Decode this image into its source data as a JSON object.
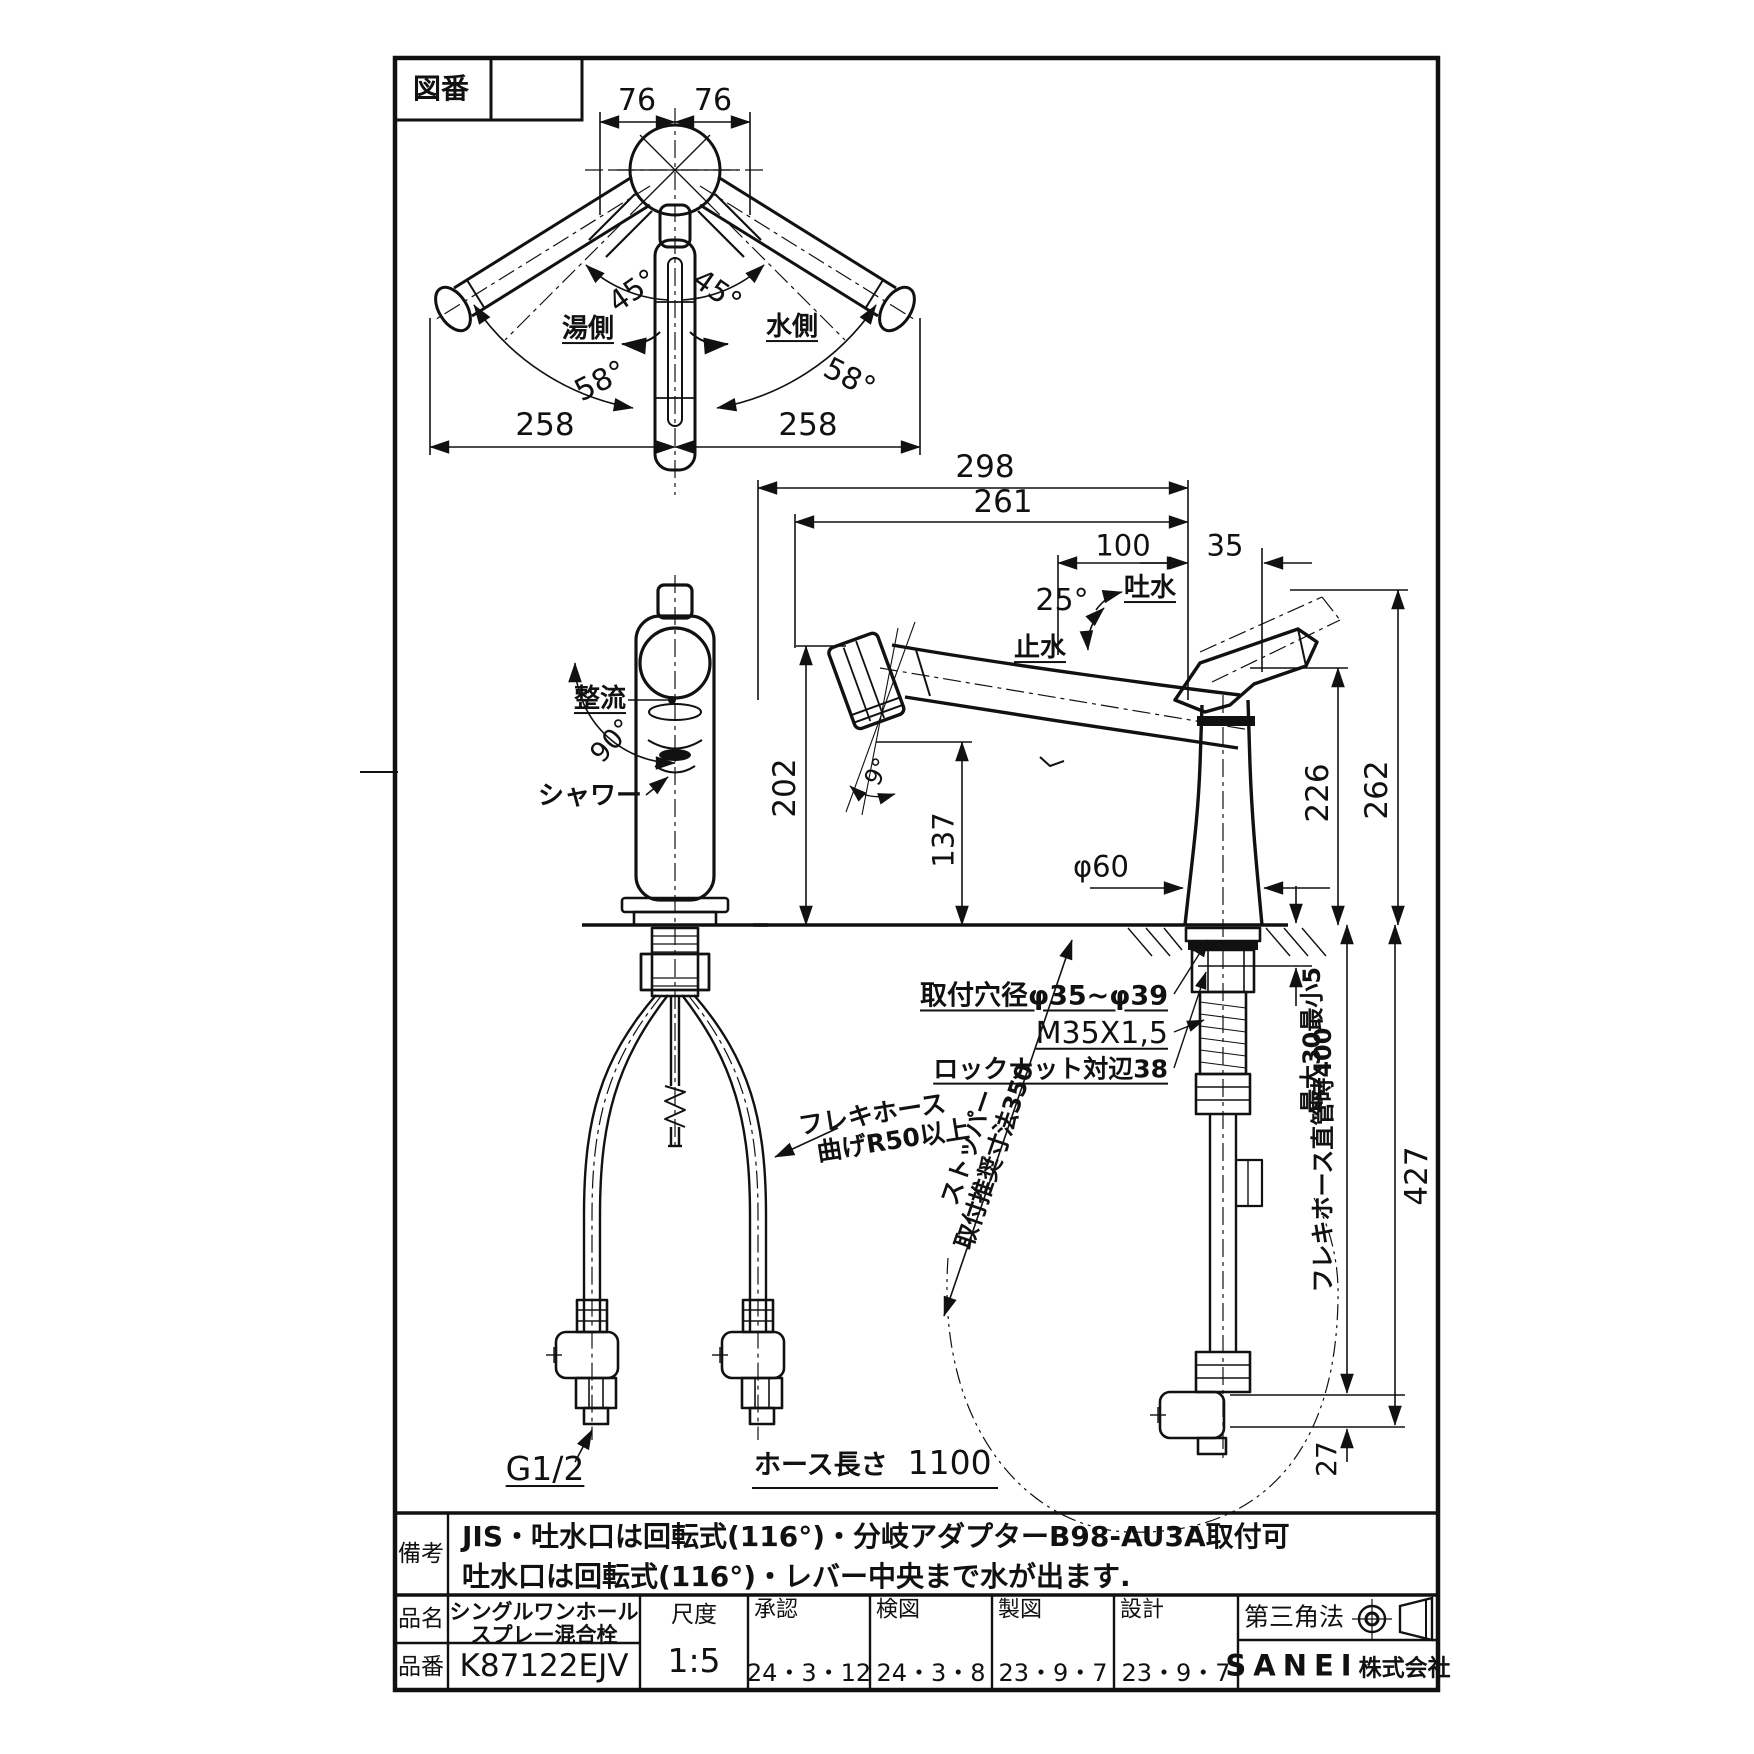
{
  "drawing_header": {
    "zuban_label": "図番"
  },
  "top_view": {
    "dim_76_left": "76",
    "dim_76_right": "76",
    "angle_45_left": "45°",
    "angle_45_right": "45°",
    "hot_side_label": "湯側",
    "cold_side_label": "水側",
    "angle_58_left": "58°",
    "angle_58_right": "58°",
    "dim_258_left": "258",
    "dim_258_right": "258"
  },
  "front_view": {
    "rectifier_label": "整流",
    "angle_90": "90°",
    "shower_label": "シャワー",
    "flex_hose_note_line1": "フレキホース",
    "flex_hose_note_line2": "曲げR50以上",
    "thread_size": "G1/2",
    "hose_length_label": "ホース長さ",
    "hose_length_value": "1100"
  },
  "side_view": {
    "dim_298": "298",
    "dim_261": "261",
    "dim_100": "100",
    "dim_35": "35",
    "angle_25": "25°",
    "spout_open_label": "吐水",
    "spout_close_label": "止水",
    "dim_202": "202",
    "dim_137": "137",
    "angle_9": "9°",
    "dim_226": "226",
    "dim_262": "262",
    "base_diameter": "φ60",
    "mount_hole_note": "取付穴径φ35~φ39",
    "thread_note": "M35X1,5",
    "locknut_note": "ロックナット対辺38",
    "counter_thickness_note": "最大30最小5",
    "flex_straight_note": "フレキホース直管時400",
    "dim_427": "427",
    "dim_27": "27",
    "stopper_note_line1": "ストッパー",
    "stopper_note_line2": "取付推奨寸法350"
  },
  "remarks": {
    "label": "備考",
    "line1": "JIS・吐水口は回転式(116°)・分岐アダプターB98-AU3A取付可",
    "line2": "吐水口は回転式(116°)・レバー中央まで水が出ます."
  },
  "title_block": {
    "product_name_label": "品名",
    "product_name_line1": "シングルワンホール",
    "product_name_line2": "スプレー混合栓",
    "product_code_label": "品番",
    "product_code": "K87122EJV",
    "scale_label": "尺度",
    "scale_value": "1:5",
    "approval_label": "承認",
    "approval_date": "24・3・12",
    "inspection_label": "検図",
    "inspection_date": "24・3・8",
    "drafting_label": "製図",
    "drafting_date": "23・9・7",
    "design_label": "設計",
    "design_date": "23・9・7",
    "projection_label": "第三角法",
    "company_name": "SANEI",
    "company_suffix": "株式会社"
  }
}
